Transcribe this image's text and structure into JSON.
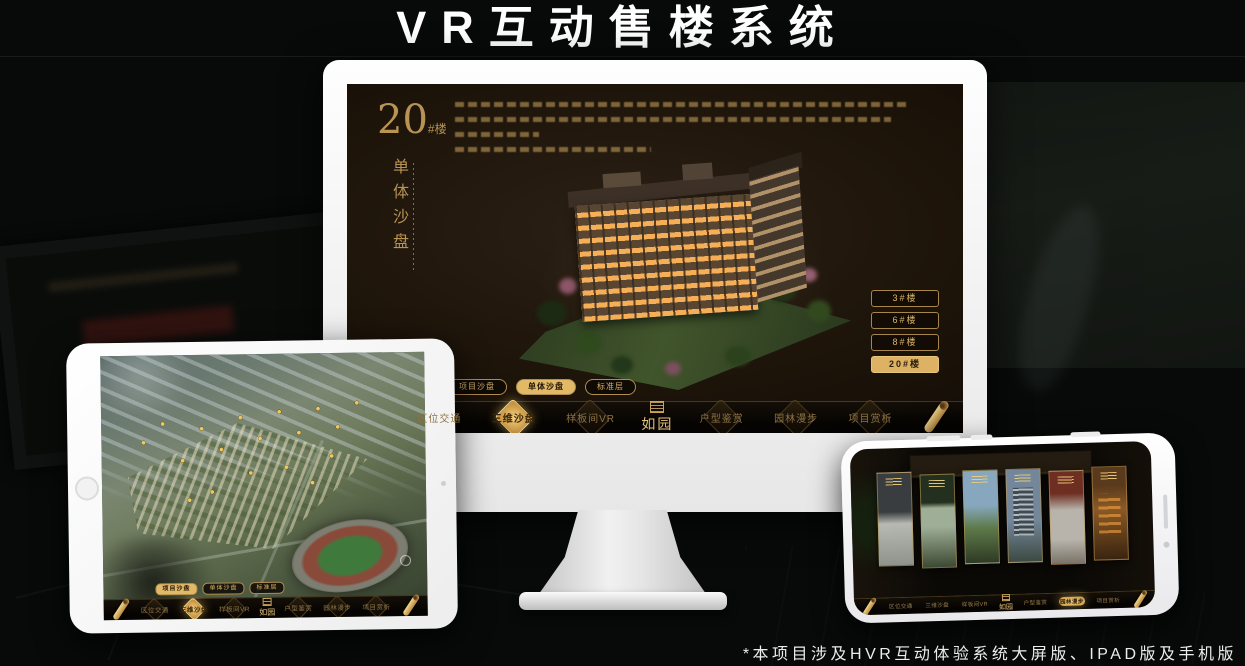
{
  "title": "VR互动售楼系统",
  "footnote": "*本项目涉及HVR互动体验系统大屏版、IPAD版及手机版",
  "colors": {
    "gold": "#c9a05e",
    "gold_bright": "#e8c176",
    "gold_fill": "#ddb264",
    "screen_bg": "#17110a"
  },
  "sandbox_screen": {
    "building_number": "20",
    "building_suffix": "#楼",
    "building_label_vertical": "单体沙盘",
    "floor_buttons": [
      {
        "label": "3#楼",
        "active": false
      },
      {
        "label": "6#楼",
        "active": false
      },
      {
        "label": "8#楼",
        "active": false
      },
      {
        "label": "20#楼",
        "active": true
      }
    ],
    "sub_tabs": [
      {
        "label": "项目沙盘",
        "active": false
      },
      {
        "label": "单体沙盘",
        "active": true
      },
      {
        "label": "标准层",
        "active": false
      }
    ]
  },
  "tablet": {
    "sub_tabs": [
      {
        "label": "项目沙盘",
        "active": true
      },
      {
        "label": "单体沙盘",
        "active": false
      },
      {
        "label": "标准层",
        "active": false
      }
    ]
  },
  "menu": {
    "logo": "如园",
    "items": [
      "区位交通",
      "三维沙盘",
      "样板间VR",
      "户型鉴赏",
      "园林漫步",
      "项目赏析"
    ],
    "active_on_monitor": "三维沙盘",
    "active_on_tablet": "三维沙盘",
    "active_on_phone": "园林漫步"
  }
}
